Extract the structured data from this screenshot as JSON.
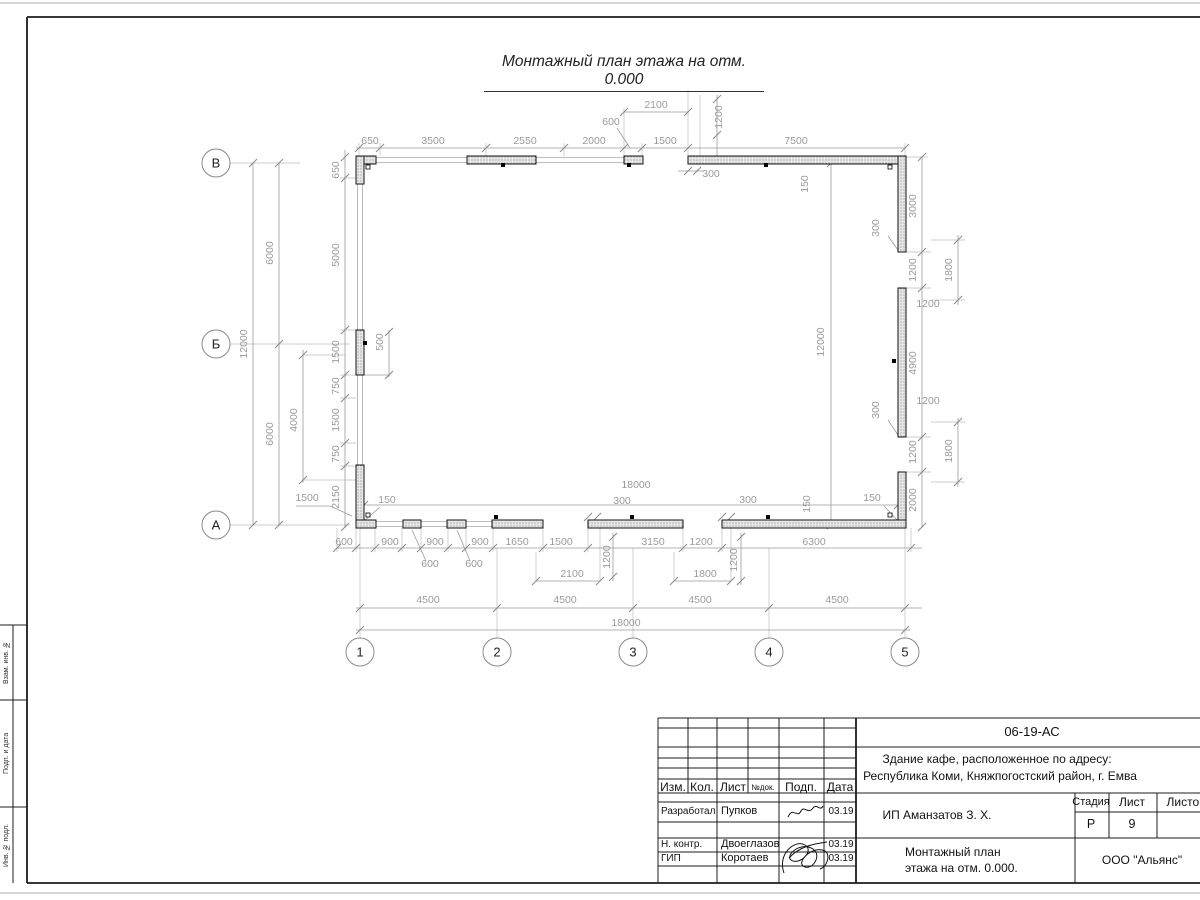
{
  "sheet": {
    "page_title": "Монтажный план этажа на отм. 0.000"
  },
  "margin_labels": {
    "top": "Взам. инв. №",
    "middle": "Подп. и дата",
    "bottom": "Инв. № подл."
  },
  "title_block": {
    "doc_code": "06-19-АС",
    "address_line1": "Здание кафе, расположенное по адресу:",
    "address_line2": "Республика Коми, Княжпогостский район, г. Емва",
    "client": "ИП Аманзатов З. Х.",
    "doc_title_line1": "Монтажный план",
    "doc_title_line2": "этажа на отм. 0.000.",
    "organization": "ООО \"Альянс\"",
    "stage_label": "Стадия",
    "stage_value": "Р",
    "sheet_label": "Лист",
    "sheet_value": "9",
    "sheets_label": "Листов",
    "cols": {
      "izm": "Изм.",
      "kol": "Кол.",
      "list": "Лист",
      "ndok": "№док.",
      "podp": "Подп.",
      "data": "Дата"
    },
    "rows": [
      {
        "role": "Разработал",
        "name": "Пупков",
        "date": "03.19"
      },
      {
        "role": "Н. контр.",
        "name": "Двоеглазов",
        "date": "03.19"
      },
      {
        "role": "ГИП",
        "name": "Коротаев",
        "date": "03.19"
      }
    ]
  },
  "plan": {
    "row_axes": [
      {
        "label": "В",
        "x": 216,
        "y": 163
      },
      {
        "label": "Б",
        "x": 216,
        "y": 344
      },
      {
        "label": "А",
        "x": 216,
        "y": 525
      }
    ],
    "col_axes": [
      {
        "label": "1",
        "x": 360,
        "y": 652
      },
      {
        "label": "2",
        "x": 497,
        "y": 652
      },
      {
        "label": "3",
        "x": 633,
        "y": 652
      },
      {
        "label": "4",
        "x": 769,
        "y": 652
      },
      {
        "label": "5",
        "x": 905,
        "y": 652
      }
    ],
    "dims": [
      {
        "t": "650",
        "x": 370,
        "y": 144
      },
      {
        "t": "3500",
        "x": 433,
        "y": 144
      },
      {
        "t": "2550",
        "x": 525,
        "y": 144
      },
      {
        "t": "2000",
        "x": 594,
        "y": 144
      },
      {
        "t": "1500",
        "x": 665,
        "y": 144
      },
      {
        "t": "7500",
        "x": 796,
        "y": 144
      },
      {
        "t": "2100",
        "x": 656,
        "y": 108
      },
      {
        "t": "600",
        "x": 611,
        "y": 125
      },
      {
        "t": "1200",
        "x": 722,
        "y": 117,
        "r": -90
      },
      {
        "t": "300",
        "x": 711,
        "y": 177
      },
      {
        "t": "150",
        "x": 808,
        "y": 184,
        "r": -90
      },
      {
        "t": "12000",
        "x": 247,
        "y": 344,
        "r": -90
      },
      {
        "t": "6000",
        "x": 273,
        "y": 253,
        "r": -90
      },
      {
        "t": "6000",
        "x": 273,
        "y": 434,
        "r": -90
      },
      {
        "t": "650",
        "x": 339,
        "y": 170,
        "r": -90
      },
      {
        "t": "5000",
        "x": 339,
        "y": 255,
        "r": -90
      },
      {
        "t": "1500",
        "x": 339,
        "y": 352,
        "r": -90
      },
      {
        "t": "750",
        "x": 339,
        "y": 386,
        "r": -90
      },
      {
        "t": "1500",
        "x": 339,
        "y": 420,
        "r": -90
      },
      {
        "t": "750",
        "x": 339,
        "y": 454,
        "r": -90
      },
      {
        "t": "2150",
        "x": 339,
        "y": 497,
        "r": -90
      },
      {
        "t": "4000",
        "x": 297,
        "y": 420,
        "r": -90
      },
      {
        "t": "500",
        "x": 383,
        "y": 342,
        "r": -90
      },
      {
        "t": "1500",
        "x": 307,
        "y": 501
      },
      {
        "t": "150",
        "x": 387,
        "y": 503
      },
      {
        "t": "3000",
        "x": 916,
        "y": 206,
        "r": -90
      },
      {
        "t": "1200",
        "x": 916,
        "y": 270,
        "r": -90
      },
      {
        "t": "4900",
        "x": 916,
        "y": 363,
        "r": -90
      },
      {
        "t": "1200",
        "x": 916,
        "y": 452,
        "r": -90
      },
      {
        "t": "2000",
        "x": 916,
        "y": 500,
        "r": -90
      },
      {
        "t": "1800",
        "x": 952,
        "y": 270,
        "r": -90
      },
      {
        "t": "1800",
        "x": 952,
        "y": 451,
        "r": -90
      },
      {
        "t": "300",
        "x": 879,
        "y": 228,
        "r": -90
      },
      {
        "t": "300",
        "x": 879,
        "y": 410,
        "r": -90
      },
      {
        "t": "1200",
        "x": 928,
        "y": 307
      },
      {
        "t": "1200",
        "x": 928,
        "y": 404
      },
      {
        "t": "150",
        "x": 872,
        "y": 501
      },
      {
        "t": "150",
        "x": 810,
        "y": 504,
        "r": -90
      },
      {
        "t": "12000",
        "x": 824,
        "y": 342,
        "r": -90
      },
      {
        "t": "18000",
        "x": 636,
        "y": 488
      },
      {
        "t": "300",
        "x": 622,
        "y": 504
      },
      {
        "t": "300",
        "x": 748,
        "y": 503
      },
      {
        "t": "600",
        "x": 344,
        "y": 545
      },
      {
        "t": "900",
        "x": 390,
        "y": 545
      },
      {
        "t": "900",
        "x": 435,
        "y": 545
      },
      {
        "t": "900",
        "x": 480,
        "y": 545
      },
      {
        "t": "1650",
        "x": 517,
        "y": 545
      },
      {
        "t": "1500",
        "x": 561,
        "y": 545
      },
      {
        "t": "3150",
        "x": 653,
        "y": 545
      },
      {
        "t": "1200",
        "x": 701,
        "y": 545
      },
      {
        "t": "6300",
        "x": 814,
        "y": 545
      },
      {
        "t": "1200",
        "x": 610,
        "y": 557,
        "r": -90
      },
      {
        "t": "1200",
        "x": 737,
        "y": 560,
        "r": -90
      },
      {
        "t": "600",
        "x": 430,
        "y": 567
      },
      {
        "t": "600",
        "x": 474,
        "y": 567
      },
      {
        "t": "2100",
        "x": 572,
        "y": 577
      },
      {
        "t": "1800",
        "x": 705,
        "y": 577
      },
      {
        "t": "4500",
        "x": 428,
        "y": 603
      },
      {
        "t": "4500",
        "x": 565,
        "y": 603
      },
      {
        "t": "4500",
        "x": 700,
        "y": 603
      },
      {
        "t": "4500",
        "x": 837,
        "y": 603
      },
      {
        "t": "18000",
        "x": 626,
        "y": 626
      }
    ]
  }
}
